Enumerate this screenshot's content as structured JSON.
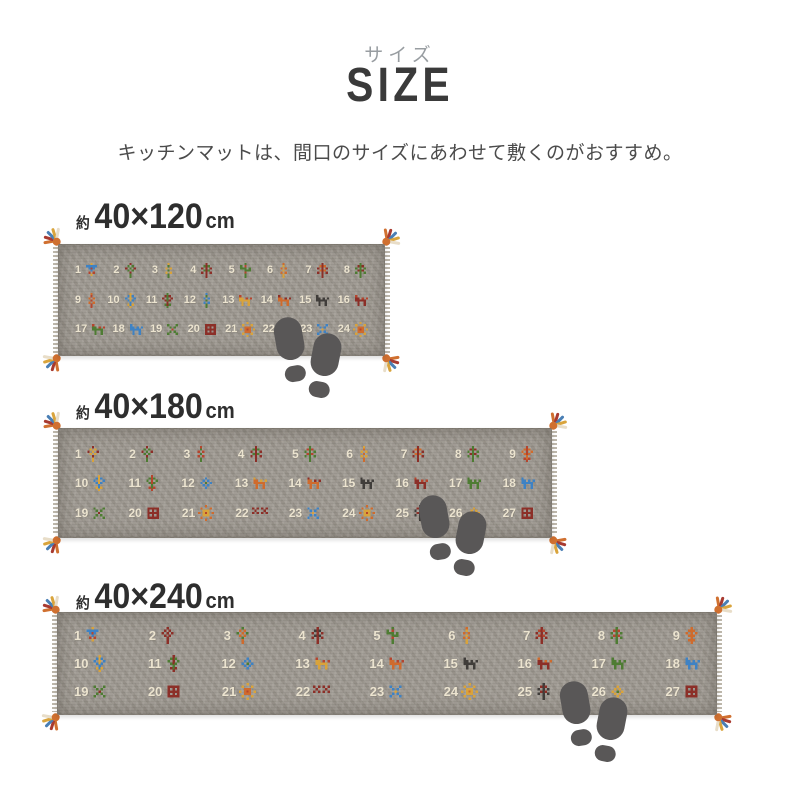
{
  "header": {
    "kicker": "サイズ",
    "title": "SIZE",
    "subtitle": "キッチンマットは、間口のサイズにあわせて敷くのがおすすめ。"
  },
  "colors": {
    "kicker": "#989da1",
    "title": "#3a3a3a",
    "subtitle": "#4b4b4b",
    "label": "#2e2e2e",
    "rug_base": "#9c978f",
    "rug_number": "#ece4d0",
    "footprint": "#595757",
    "tassel": [
      "#d07030",
      "#a83a30",
      "#4a7fb5",
      "#d9a43c",
      "#e8ddc8"
    ]
  },
  "motif_colors": {
    "maroon": "#8c2f28",
    "red": "#b5452e",
    "green": "#4e7c33",
    "blue": "#3e82c4",
    "gold": "#d9a33b",
    "orange": "#cf6b2d",
    "dark": "#403d3a",
    "cream": "#e9e1cd"
  },
  "rugs": [
    {
      "label": {
        "prefix": "約",
        "dims": "40×120",
        "unit": "cm"
      },
      "label_pos": {
        "x": 76,
        "y": 197
      },
      "geometry": {
        "x": 58,
        "y": 244,
        "w": 327,
        "h": 112
      },
      "footprints": {
        "x": 265,
        "y": 312
      },
      "rows": [
        [
          {
            "n": "1",
            "type": "bird",
            "colors": [
              "blue",
              "gold",
              "red"
            ]
          },
          {
            "n": "2",
            "type": "flower",
            "colors": [
              "maroon",
              "green"
            ]
          },
          {
            "n": "3",
            "type": "plant",
            "colors": [
              "green",
              "gold"
            ]
          },
          {
            "n": "4",
            "type": "tree",
            "colors": [
              "maroon",
              "green"
            ]
          },
          {
            "n": "5",
            "type": "cactus",
            "colors": [
              "green",
              "red"
            ]
          },
          {
            "n": "6",
            "type": "plant",
            "colors": [
              "gold",
              "orange"
            ]
          },
          {
            "n": "7",
            "type": "tree",
            "colors": [
              "maroon",
              "orange"
            ]
          },
          {
            "n": "8",
            "type": "tree",
            "colors": [
              "green",
              "maroon"
            ]
          }
        ],
        [
          {
            "n": "9",
            "type": "plant",
            "colors": [
              "red",
              "orange"
            ]
          },
          {
            "n": "10",
            "type": "vase",
            "colors": [
              "blue",
              "gold"
            ]
          },
          {
            "n": "11",
            "type": "vase",
            "colors": [
              "maroon",
              "green"
            ]
          },
          {
            "n": "12",
            "type": "plant",
            "colors": [
              "green",
              "blue"
            ]
          },
          {
            "n": "13",
            "type": "animal",
            "colors": [
              "gold",
              "red"
            ]
          },
          {
            "n": "14",
            "type": "animal",
            "colors": [
              "orange",
              "maroon"
            ]
          },
          {
            "n": "15",
            "type": "animal",
            "colors": [
              "dark",
              "dark"
            ]
          },
          {
            "n": "16",
            "type": "animal",
            "colors": [
              "maroon",
              "red"
            ]
          }
        ],
        [
          {
            "n": "17",
            "type": "animal",
            "colors": [
              "green",
              "red"
            ]
          },
          {
            "n": "18",
            "type": "animal",
            "colors": [
              "blue",
              "blue"
            ]
          },
          {
            "n": "19",
            "type": "x",
            "colors": [
              "green",
              "red"
            ]
          },
          {
            "n": "20",
            "type": "gul",
            "colors": [
              "maroon"
            ]
          },
          {
            "n": "21",
            "type": "sun",
            "colors": [
              "gold",
              "orange",
              "red"
            ]
          },
          {
            "n": "22",
            "type": "xx",
            "colors": [
              "maroon"
            ]
          },
          {
            "n": "23",
            "type": "x",
            "colors": [
              "blue",
              "gold"
            ]
          },
          {
            "n": "24",
            "type": "sun",
            "colors": [
              "gold",
              "orange",
              "red"
            ]
          }
        ]
      ]
    },
    {
      "label": {
        "prefix": "約",
        "dims": "40×180",
        "unit": "cm"
      },
      "label_pos": {
        "x": 76,
        "y": 387
      },
      "geometry": {
        "x": 58,
        "y": 428,
        "w": 494,
        "h": 110
      },
      "footprints": {
        "x": 410,
        "y": 490
      },
      "rows": [
        [
          {
            "n": "1",
            "type": "flower",
            "colors": [
              "maroon",
              "gold"
            ]
          },
          {
            "n": "2",
            "type": "flower",
            "colors": [
              "maroon",
              "green"
            ]
          },
          {
            "n": "3",
            "type": "plant",
            "colors": [
              "green",
              "red"
            ]
          },
          {
            "n": "4",
            "type": "tree",
            "colors": [
              "maroon",
              "green"
            ]
          },
          {
            "n": "5",
            "type": "tree",
            "colors": [
              "green",
              "red"
            ]
          },
          {
            "n": "6",
            "type": "plant",
            "colors": [
              "orange",
              "gold"
            ]
          },
          {
            "n": "7",
            "type": "tree",
            "colors": [
              "maroon",
              "orange"
            ]
          },
          {
            "n": "8",
            "type": "tree",
            "colors": [
              "green",
              "maroon"
            ]
          },
          {
            "n": "9",
            "type": "vase",
            "colors": [
              "orange",
              "red"
            ]
          }
        ],
        [
          {
            "n": "10",
            "type": "vase",
            "colors": [
              "blue",
              "gold"
            ]
          },
          {
            "n": "11",
            "type": "vase",
            "colors": [
              "green",
              "red"
            ]
          },
          {
            "n": "12",
            "type": "diamond",
            "colors": [
              "blue",
              "green"
            ]
          },
          {
            "n": "13",
            "type": "animal",
            "colors": [
              "orange",
              "gold"
            ]
          },
          {
            "n": "14",
            "type": "animal",
            "colors": [
              "orange",
              "maroon"
            ]
          },
          {
            "n": "15",
            "type": "animal",
            "colors": [
              "dark",
              "dark"
            ]
          },
          {
            "n": "16",
            "type": "animal",
            "colors": [
              "maroon",
              "red"
            ]
          },
          {
            "n": "17",
            "type": "animal",
            "colors": [
              "green",
              "green"
            ]
          },
          {
            "n": "18",
            "type": "animal",
            "colors": [
              "blue",
              "blue"
            ]
          }
        ],
        [
          {
            "n": "19",
            "type": "x",
            "colors": [
              "green",
              "maroon"
            ]
          },
          {
            "n": "20",
            "type": "gul",
            "colors": [
              "maroon"
            ]
          },
          {
            "n": "21",
            "type": "sun",
            "colors": [
              "orange",
              "gold",
              "red"
            ]
          },
          {
            "n": "22",
            "type": "xx",
            "colors": [
              "maroon"
            ]
          },
          {
            "n": "23",
            "type": "x",
            "colors": [
              "blue",
              "gold"
            ]
          },
          {
            "n": "24",
            "type": "sun",
            "colors": [
              "orange",
              "gold",
              "red"
            ]
          },
          {
            "n": "25",
            "type": "tree",
            "colors": [
              "dark",
              "maroon"
            ]
          },
          {
            "n": "26",
            "type": "diamond",
            "colors": [
              "gold",
              "green"
            ]
          },
          {
            "n": "27",
            "type": "gul",
            "colors": [
              "maroon"
            ]
          }
        ]
      ]
    },
    {
      "label": {
        "prefix": "約",
        "dims": "40×240",
        "unit": "cm"
      },
      "label_pos": {
        "x": 76,
        "y": 577
      },
      "geometry": {
        "x": 57,
        "y": 612,
        "w": 660,
        "h": 103
      },
      "footprints": {
        "x": 551,
        "y": 676
      },
      "rows": [
        [
          {
            "n": "1",
            "type": "bird",
            "colors": [
              "blue",
              "gold",
              "red"
            ]
          },
          {
            "n": "2",
            "type": "flower",
            "colors": [
              "maroon",
              "maroon"
            ]
          },
          {
            "n": "3",
            "type": "flower",
            "colors": [
              "green",
              "orange"
            ]
          },
          {
            "n": "4",
            "type": "tree",
            "colors": [
              "maroon",
              "dark"
            ]
          },
          {
            "n": "5",
            "type": "cactus",
            "colors": [
              "green",
              "red"
            ]
          },
          {
            "n": "6",
            "type": "plant",
            "colors": [
              "gold",
              "orange"
            ]
          },
          {
            "n": "7",
            "type": "tree",
            "colors": [
              "maroon",
              "red"
            ]
          },
          {
            "n": "8",
            "type": "tree",
            "colors": [
              "green",
              "red"
            ]
          },
          {
            "n": "9",
            "type": "vase",
            "colors": [
              "orange",
              "orange"
            ]
          }
        ],
        [
          {
            "n": "10",
            "type": "vase",
            "colors": [
              "blue",
              "gold"
            ]
          },
          {
            "n": "11",
            "type": "vase",
            "colors": [
              "green",
              "maroon"
            ]
          },
          {
            "n": "12",
            "type": "diamond",
            "colors": [
              "blue",
              "green"
            ]
          },
          {
            "n": "13",
            "type": "animal",
            "colors": [
              "gold",
              "red"
            ]
          },
          {
            "n": "14",
            "type": "animal",
            "colors": [
              "orange",
              "red"
            ]
          },
          {
            "n": "15",
            "type": "animal",
            "colors": [
              "dark",
              "dark"
            ]
          },
          {
            "n": "16",
            "type": "animal",
            "colors": [
              "maroon",
              "orange"
            ]
          },
          {
            "n": "17",
            "type": "animal",
            "colors": [
              "green",
              "green"
            ]
          },
          {
            "n": "18",
            "type": "animal",
            "colors": [
              "blue",
              "blue"
            ]
          }
        ],
        [
          {
            "n": "19",
            "type": "x",
            "colors": [
              "green",
              "maroon"
            ]
          },
          {
            "n": "20",
            "type": "gul",
            "colors": [
              "maroon"
            ]
          },
          {
            "n": "21",
            "type": "sun",
            "colors": [
              "gold",
              "orange",
              "red"
            ]
          },
          {
            "n": "22",
            "type": "xx",
            "colors": [
              "maroon"
            ]
          },
          {
            "n": "23",
            "type": "x",
            "colors": [
              "blue",
              "gold"
            ]
          },
          {
            "n": "24",
            "type": "sun",
            "colors": [
              "gold",
              "gold",
              "orange"
            ]
          },
          {
            "n": "25",
            "type": "tree",
            "colors": [
              "dark",
              "maroon"
            ]
          },
          {
            "n": "26",
            "type": "diamond",
            "colors": [
              "gold",
              "green"
            ]
          },
          {
            "n": "27",
            "type": "gul",
            "colors": [
              "maroon"
            ]
          }
        ]
      ]
    }
  ]
}
